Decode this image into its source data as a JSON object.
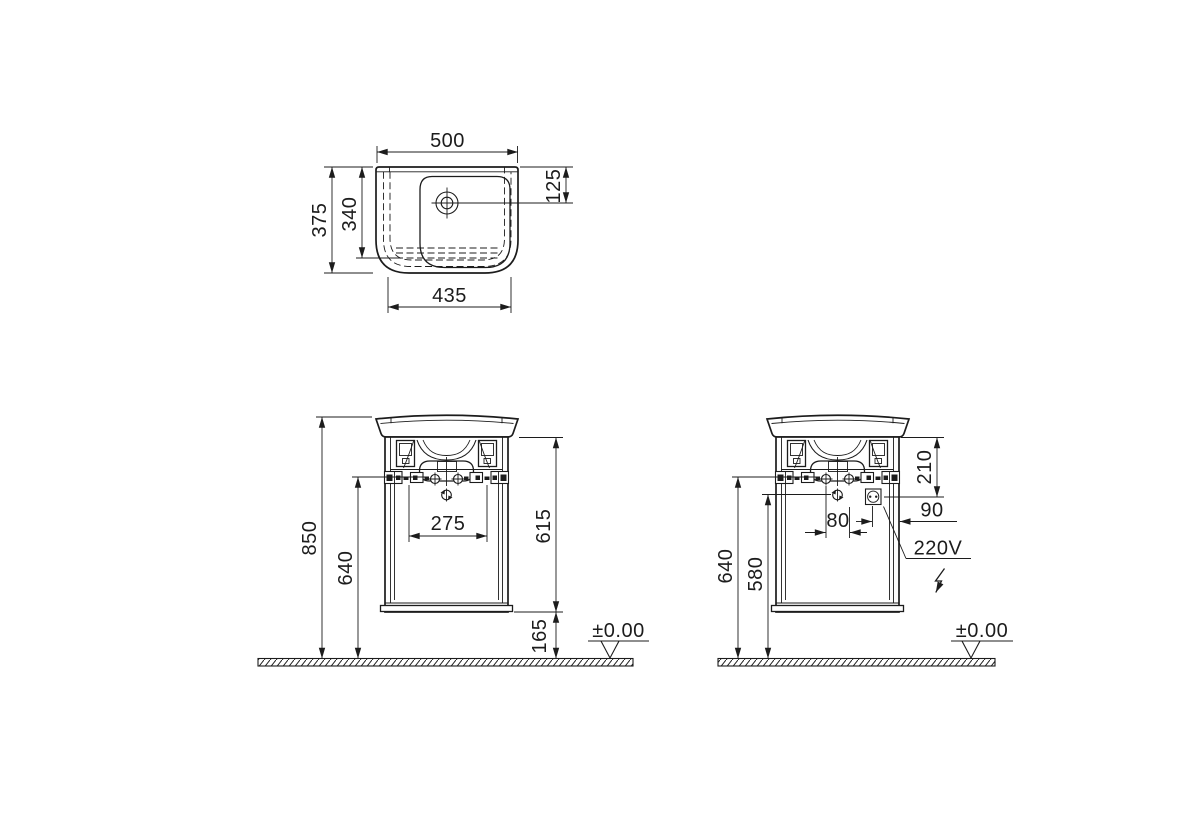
{
  "drawing": {
    "background_color": "#ffffff",
    "line_color": "#1c1c1c",
    "plan_view": {
      "overall_width": "500",
      "overall_depth": "375",
      "bowl_depth": "340",
      "tap_hole_offset": "125",
      "base_width": "435"
    },
    "front_view": {
      "overall_height": "850",
      "bracket_height": "640",
      "fixing_spacing": "275",
      "cabinet_height": "615",
      "floor_clearance": "165",
      "floor_level": "±0.00"
    },
    "electric_view": {
      "bracket_height": "640",
      "trap_height": "580",
      "fixing_spacing": "80",
      "socket_offset": "90",
      "socket_drop": "210",
      "socket_voltage": "220V",
      "floor_level": "±0.00"
    }
  }
}
